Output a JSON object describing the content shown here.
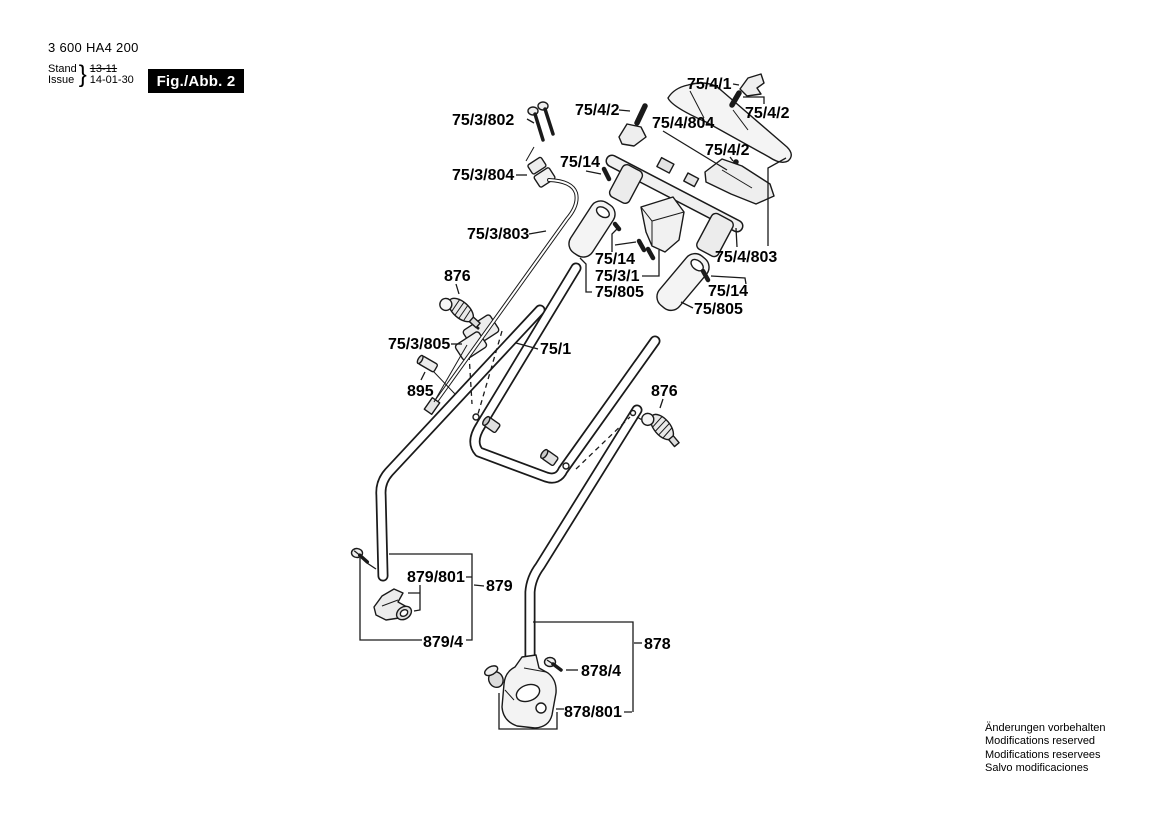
{
  "header": {
    "part_number": "3 600 HA4 200",
    "revision": {
      "stand_label": "Stand",
      "issue_label": "Issue",
      "old_value": "13-11",
      "new_value": "14-01-30"
    },
    "figure_label": "Fig./Abb. 2"
  },
  "footer": {
    "notice_lines": [
      "Änderungen vorbehalten",
      "Modifications reserved",
      "Modifications reservees",
      "Salvo modificaciones"
    ]
  },
  "diagram": {
    "description": "Exploded view of lawnmower handle assembly",
    "part_labels": [
      {
        "id": "75-3-802",
        "text": "75/3/802",
        "x": 452,
        "y": 125
      },
      {
        "id": "75-4-2-a",
        "text": "75/4/2",
        "x": 575,
        "y": 115
      },
      {
        "id": "75-4-1",
        "text": "75/4/1",
        "x": 687,
        "y": 89
      },
      {
        "id": "75-4-2-b",
        "text": "75/4/2",
        "x": 745,
        "y": 118
      },
      {
        "id": "75-4-804",
        "text": "75/4/804",
        "x": 652,
        "y": 128
      },
      {
        "id": "75-4-2-c",
        "text": "75/4/2",
        "x": 705,
        "y": 155
      },
      {
        "id": "75-3-804",
        "text": "75/3/804",
        "x": 452,
        "y": 180
      },
      {
        "id": "75-14-a",
        "text": "75/14",
        "x": 560,
        "y": 167
      },
      {
        "id": "75-3-803",
        "text": "75/3/803",
        "x": 467,
        "y": 239
      },
      {
        "id": "75-14-b",
        "text": "75/14",
        "x": 595,
        "y": 264
      },
      {
        "id": "75-3-1",
        "text": "75/3/1",
        "x": 595,
        "y": 281
      },
      {
        "id": "75-805-a",
        "text": "75/805",
        "x": 595,
        "y": 297
      },
      {
        "id": "75-4-803",
        "text": "75/4/803",
        "x": 715,
        "y": 262
      },
      {
        "id": "75-14-c",
        "text": "75/14",
        "x": 708,
        "y": 296
      },
      {
        "id": "75-805-b",
        "text": "75/805",
        "x": 694,
        "y": 314
      },
      {
        "id": "876-a",
        "text": "876",
        "x": 444,
        "y": 281
      },
      {
        "id": "75-3-805",
        "text": "75/3/805",
        "x": 388,
        "y": 349
      },
      {
        "id": "75-1",
        "text": "75/1",
        "x": 540,
        "y": 354
      },
      {
        "id": "895",
        "text": "895",
        "x": 407,
        "y": 396
      },
      {
        "id": "876-b",
        "text": "876",
        "x": 651,
        "y": 396
      },
      {
        "id": "879-801",
        "text": "879/801",
        "x": 407,
        "y": 582
      },
      {
        "id": "879",
        "text": "879",
        "x": 486,
        "y": 591
      },
      {
        "id": "879-4",
        "text": "879/4",
        "x": 423,
        "y": 647
      },
      {
        "id": "878",
        "text": "878",
        "x": 644,
        "y": 649
      },
      {
        "id": "878-4",
        "text": "878/4",
        "x": 581,
        "y": 676
      },
      {
        "id": "878-801",
        "text": "878/801",
        "x": 564,
        "y": 717
      }
    ]
  },
  "colors": {
    "line": "#1a1a1a",
    "part_fill": "#f2f2f2",
    "badge_bg": "#000000",
    "badge_fg": "#ffffff"
  }
}
